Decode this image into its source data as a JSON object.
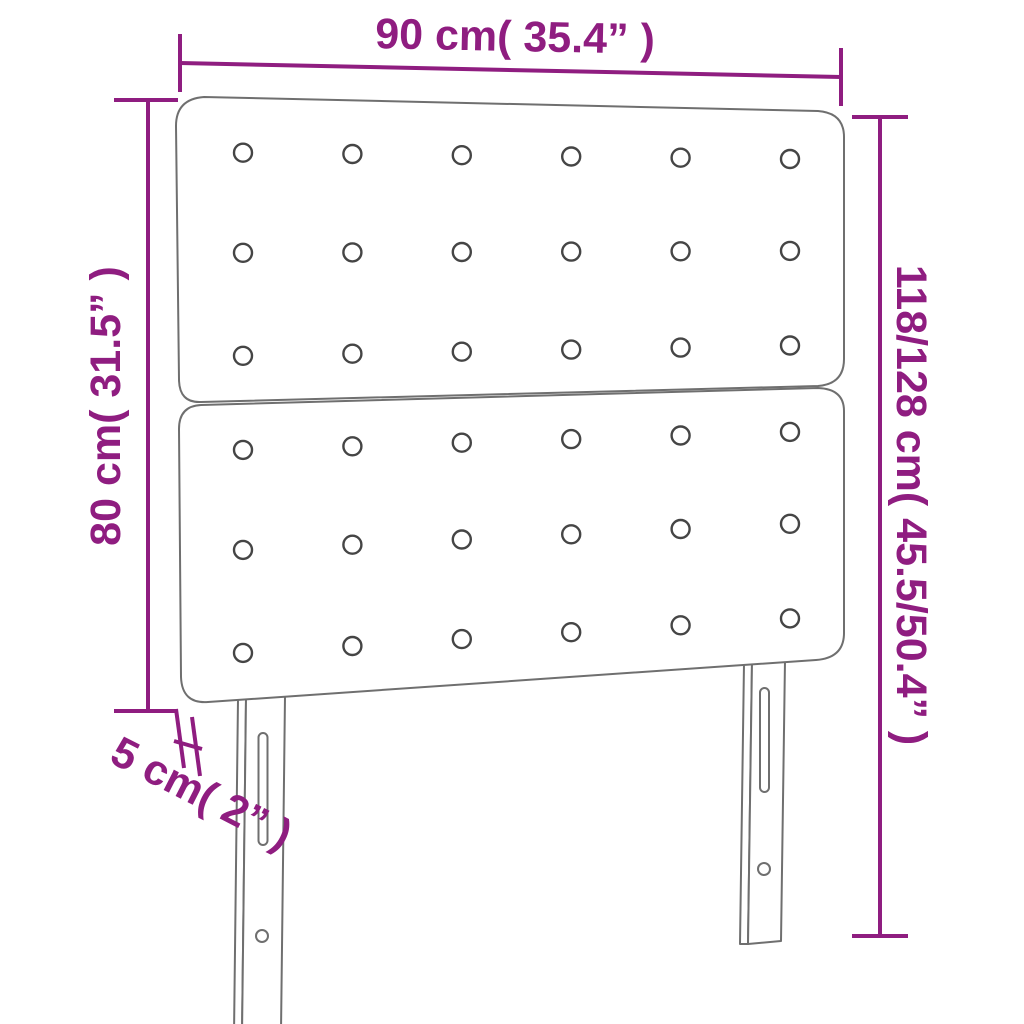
{
  "title": "Headboard dimension diagram",
  "dimensions": {
    "width": "90 cm( 35.4” )",
    "height_left": "80 cm( 31.5” )",
    "height_total": "118/128 cm( 45.5/50.4” )",
    "depth": "5 cm( 2” )"
  },
  "colors": {
    "dimension_line": "#8f1d80",
    "product_outline": "#6f6f6f",
    "button_outline": "#454545",
    "background": "#ffffff"
  },
  "drawing": {
    "panels": 2,
    "button_columns": 6,
    "button_rows_per_panel": 3,
    "legs": 2
  }
}
